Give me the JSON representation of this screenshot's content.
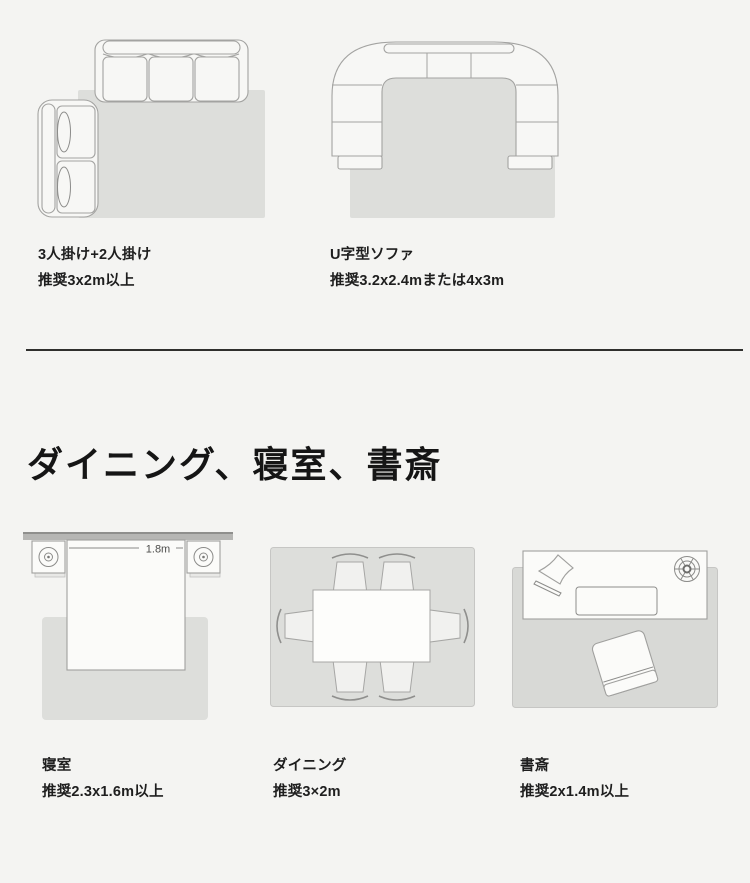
{
  "page": {
    "background_color": "#f4f4f2",
    "divider_color": "#2f2f2d",
    "heading": "ダイニング、寝室、書斎"
  },
  "sofa_section": {
    "figures": [
      {
        "title": "3人掛け+2人掛け",
        "size": "推奨3x2m以上"
      },
      {
        "title": "U字型ソファ",
        "size": "推奨3.2x2.4mまたは4x3m"
      }
    ]
  },
  "rooms_section": {
    "figures": [
      {
        "title": "寝室",
        "size": "推奨2.3x1.6m以上",
        "bed_width_label": "1.8m"
      },
      {
        "title": "ダイニング",
        "size": "推奨3×2m"
      },
      {
        "title": "書斎",
        "size": "推奨2x1.4m以上"
      }
    ]
  },
  "icons": {
    "nightstand_lamp": "lamp-icon",
    "desk_fan": "fan-icon",
    "desk_lamp": "desk-lamp-icon"
  },
  "colors": {
    "rug": "#dddedb",
    "rug_dark": "#d8d9d6",
    "furniture_fill": "#f7f7f5",
    "furniture_stroke": "#a3a3a1",
    "wall": "#b6b6b4",
    "text": "#1e1e1e",
    "dimension_text": "#4c4c4a"
  }
}
